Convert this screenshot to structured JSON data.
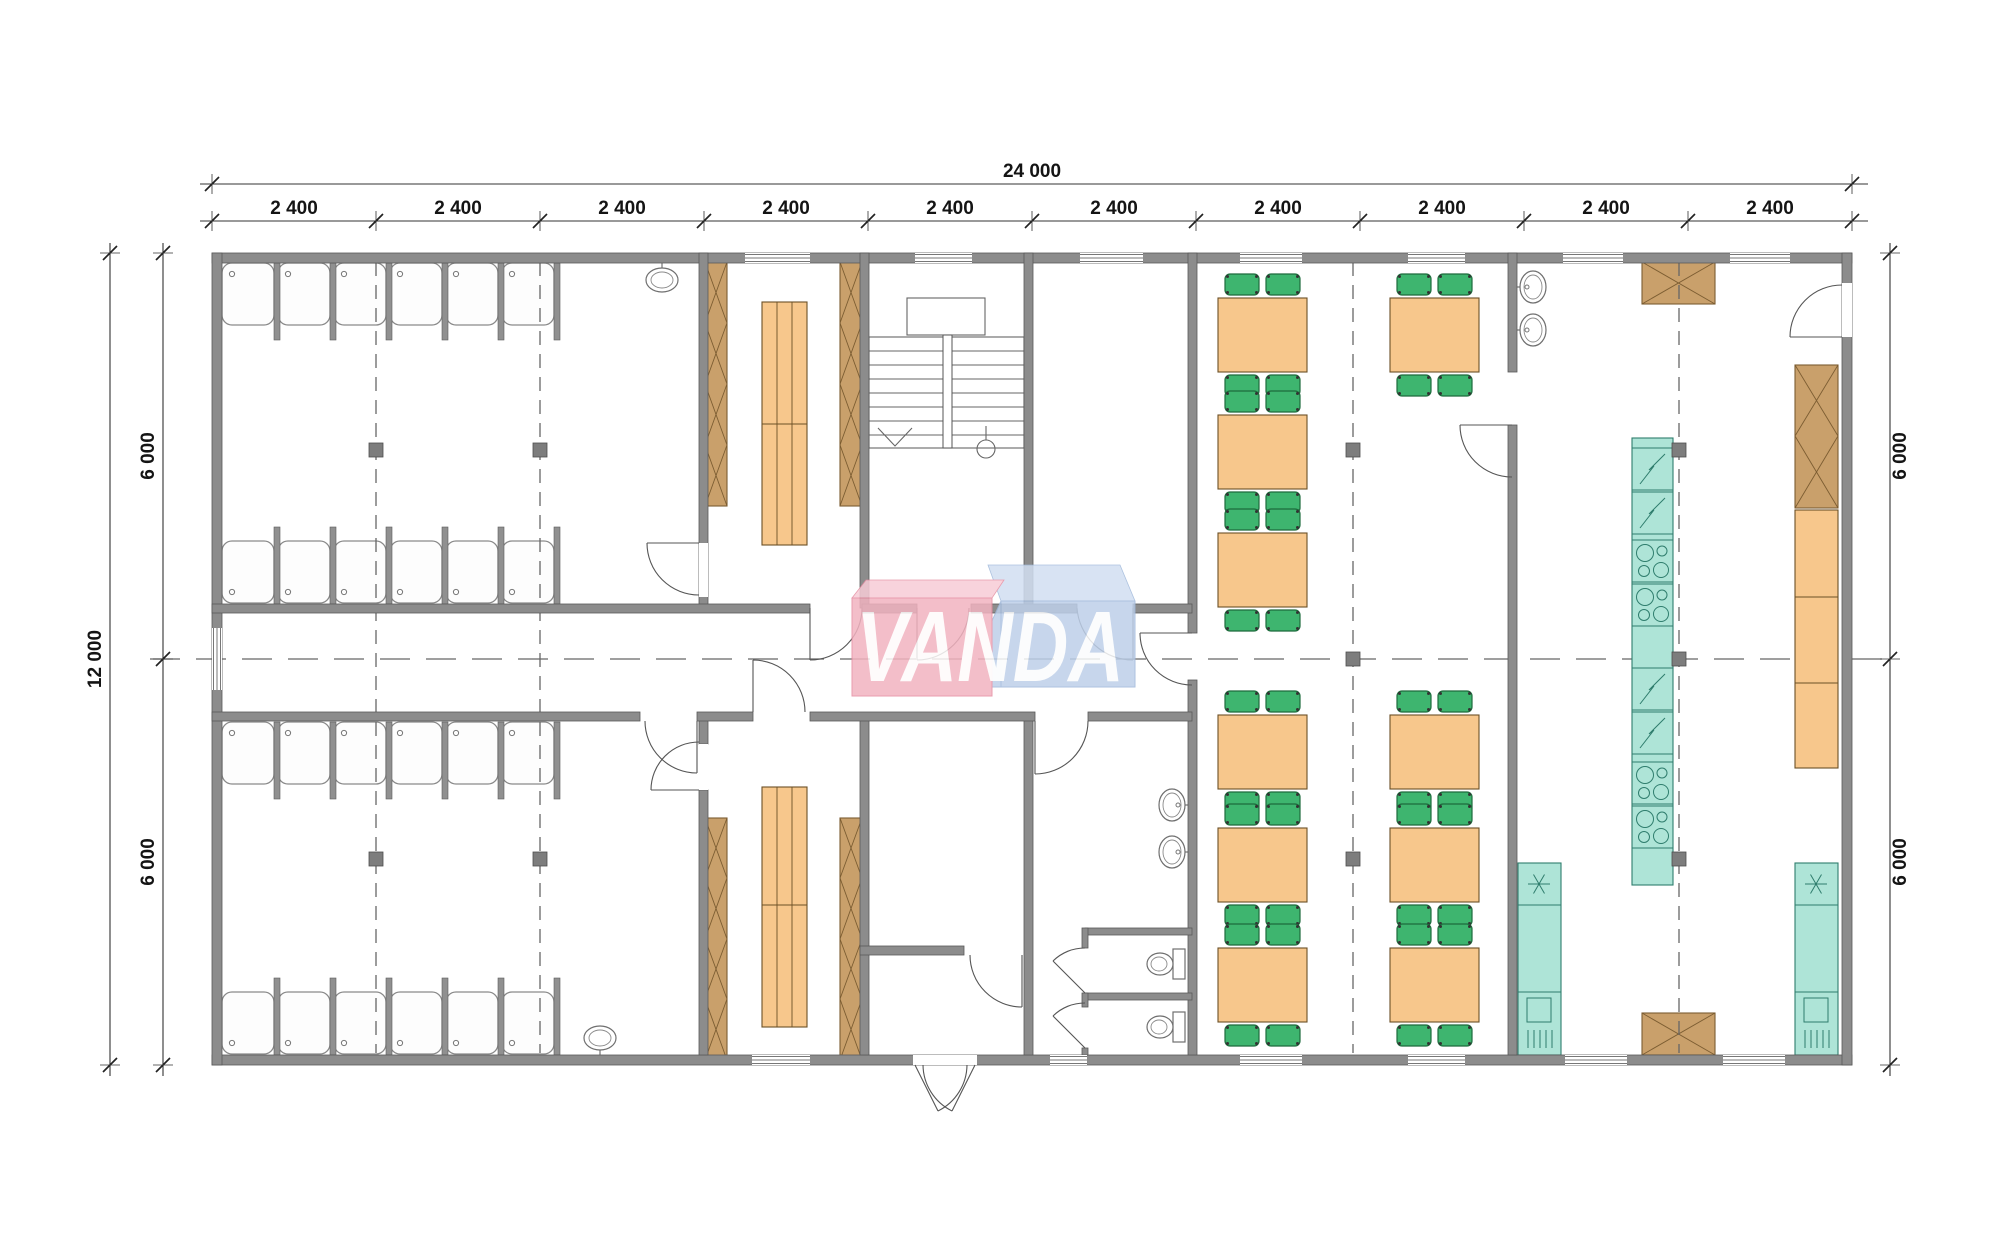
{
  "title": "Modular building floor plan - showers, changing rooms, dining room and kitchen",
  "watermark": {
    "text": "VANDA"
  },
  "dimensions": {
    "top_total": "24 000",
    "top_segments": [
      "2 400",
      "2 400",
      "2 400",
      "2 400",
      "2 400",
      "2 400",
      "2 400",
      "2 400",
      "2 400",
      "2 400"
    ],
    "left_total": "12 000",
    "left_segments": [
      "6 000",
      "6 000"
    ],
    "right_segments": [
      "6 000",
      "6 000"
    ]
  },
  "rooms": [
    {
      "id": "shower-room-top",
      "fixtures": {
        "shower_stalls": 12,
        "wash_basins": 1
      }
    },
    {
      "id": "changing-room-top",
      "fixtures": {
        "wardrobe_columns": 2,
        "benches": 1
      }
    },
    {
      "id": "stair-hall",
      "fixtures": {
        "staircases": 1
      }
    },
    {
      "id": "vestibule",
      "fixtures": {}
    },
    {
      "id": "corridor",
      "fixtures": {}
    },
    {
      "id": "shower-room-bottom",
      "fixtures": {
        "shower_stalls": 12,
        "wash_basins": 1
      }
    },
    {
      "id": "changing-room-bottom",
      "fixtures": {
        "wardrobe_columns": 2,
        "benches": 1
      }
    },
    {
      "id": "entrance-hall",
      "fixtures": {
        "double_entrance_doors": 1
      }
    },
    {
      "id": "wc",
      "fixtures": {
        "wash_basins": 2,
        "toilet_stalls": 2
      }
    },
    {
      "id": "dining-room",
      "fixtures": {
        "tables": 10,
        "chairs": 40
      }
    },
    {
      "id": "kitchen",
      "fixtures": {
        "fridges": 4,
        "stoves": 4,
        "sink_units": 2,
        "cabinets": 3,
        "counters": 1
      }
    }
  ],
  "colors": {
    "wall": "#8c8c8c",
    "wall_edge": "#595959",
    "wood": "#c9a06b",
    "wood_edge": "#7c5d32",
    "bench": "#f7c78c",
    "bench_edge": "#6b5026",
    "chair": "#3eb56f",
    "chair_edge": "#1d6b3c",
    "appliance": "#aee4d7",
    "appliance_edge": "#2f7d6d",
    "axis": "#666666",
    "watermark_pink": "#f2b3c0",
    "watermark_blue": "#bed0e9"
  }
}
